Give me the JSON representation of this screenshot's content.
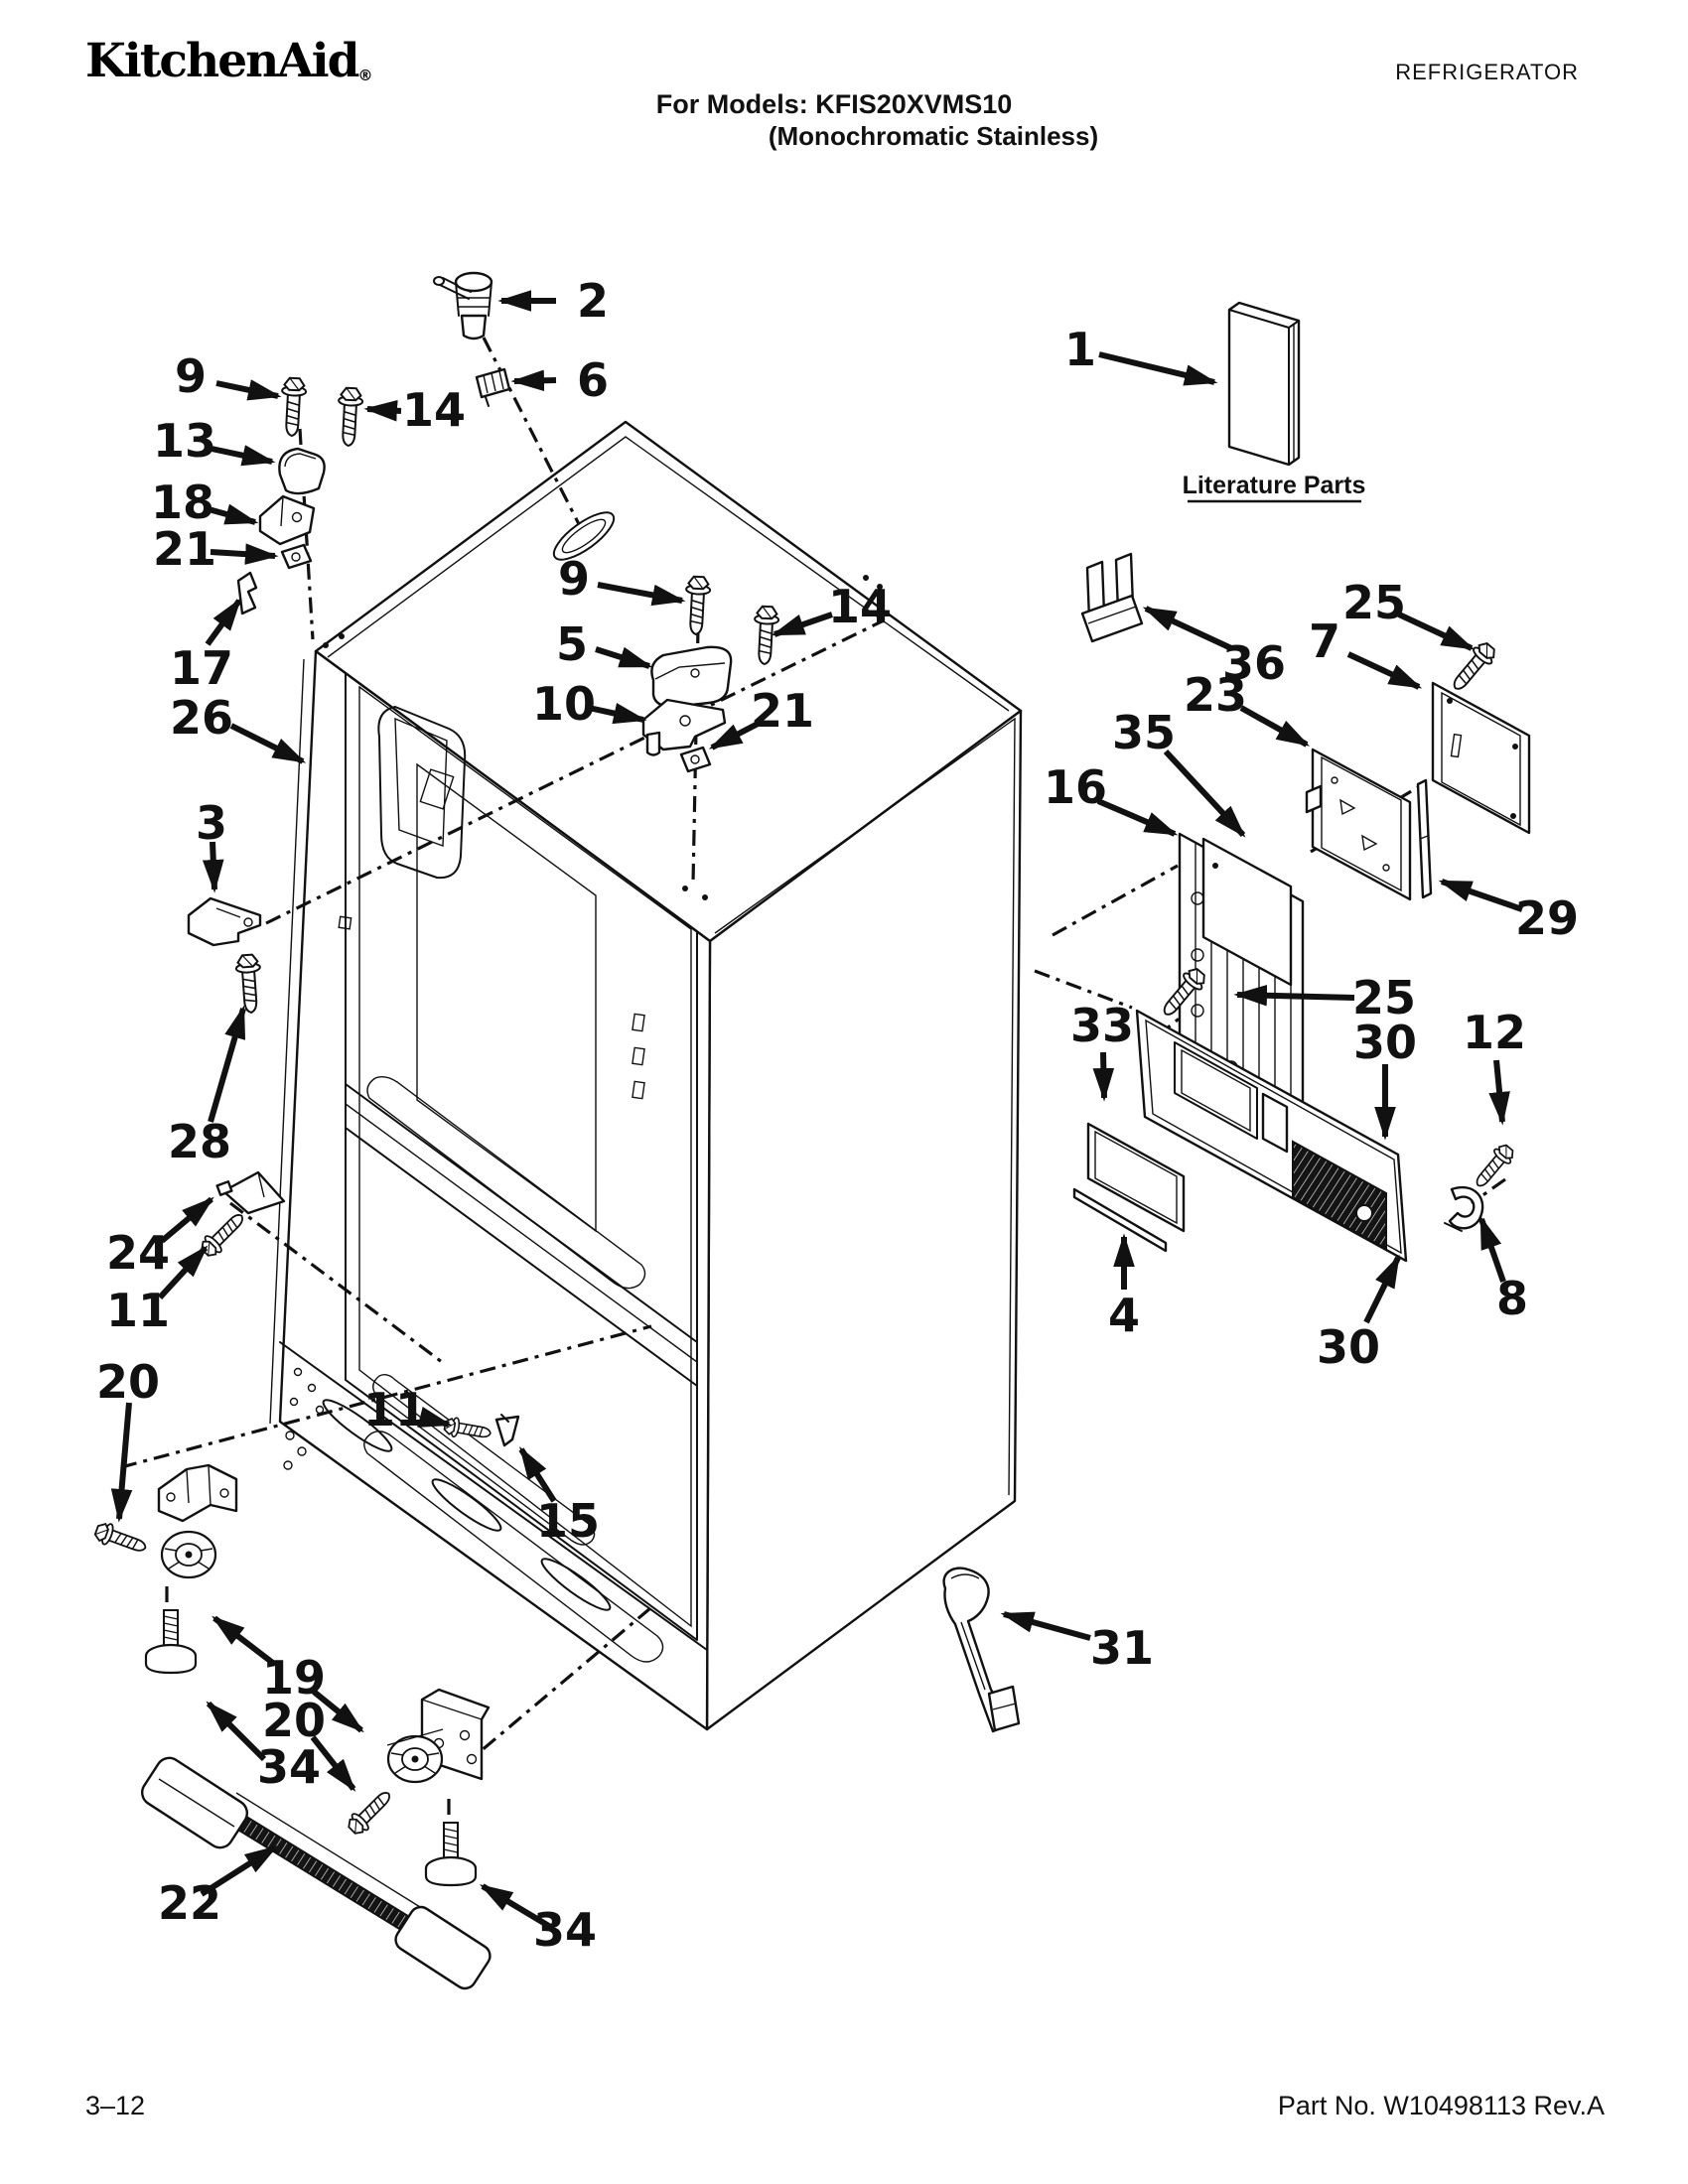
{
  "header": {
    "brand": "KitchenAid",
    "brand_registered": "®",
    "doc_type": "REFRIGERATOR",
    "models_line": "For Models: KFIS20XVMS10",
    "finish_line": "(Monochromatic Stainless)"
  },
  "literature": {
    "label": "Literature Parts"
  },
  "footer": {
    "page": "3–12",
    "part_no": "Part No. W10498113 Rev.A"
  },
  "colors": {
    "ink": "#111111",
    "paper": "#ffffff"
  },
  "diagram": {
    "subject": "refrigerator-cabinet-exploded-view"
  },
  "callouts": [
    {
      "label": "2"
    },
    {
      "label": "6"
    },
    {
      "label": "9"
    },
    {
      "label": "14"
    },
    {
      "label": "13"
    },
    {
      "label": "18"
    },
    {
      "label": "21"
    },
    {
      "label": "17"
    },
    {
      "label": "26"
    },
    {
      "label": "3"
    },
    {
      "label": "28"
    },
    {
      "label": "24"
    },
    {
      "label": "11"
    },
    {
      "label": "20"
    },
    {
      "label": "9"
    },
    {
      "label": "5"
    },
    {
      "label": "14"
    },
    {
      "label": "10"
    },
    {
      "label": "21"
    },
    {
      "label": "1"
    },
    {
      "label": "36"
    },
    {
      "label": "7"
    },
    {
      "label": "25"
    },
    {
      "label": "23"
    },
    {
      "label": "35"
    },
    {
      "label": "16"
    },
    {
      "label": "29"
    },
    {
      "label": "25"
    },
    {
      "label": "30"
    },
    {
      "label": "12"
    },
    {
      "label": "33"
    },
    {
      "label": "4"
    },
    {
      "label": "8"
    },
    {
      "label": "30"
    },
    {
      "label": "31"
    },
    {
      "label": "11"
    },
    {
      "label": "15"
    },
    {
      "label": "19"
    },
    {
      "label": "20"
    },
    {
      "label": "34"
    },
    {
      "label": "22"
    },
    {
      "label": "34"
    }
  ]
}
